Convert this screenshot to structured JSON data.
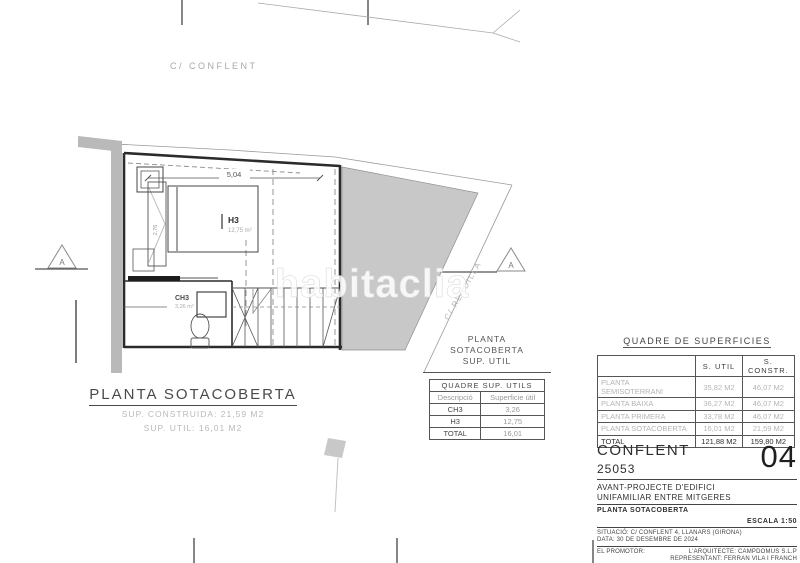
{
  "streets": {
    "conflent": "C/ CONFLENT",
    "rendilla": "C/ RENDILLA"
  },
  "watermark": "habitaclia",
  "plan": {
    "dim_width": "5,04",
    "dim_bed": "2,76",
    "room_h3": "H3",
    "room_h3_area": "12,75 m²",
    "room_ch3": "CH3",
    "room_ch3_area": "3,26 m²",
    "section_marker": "A",
    "title": "PLANTA SOTACOBERTA",
    "sup_construida": "SUP. CONSTRUIDA: 21,59 M2",
    "sup_util": "SUP. UTIL: 16,01 M2"
  },
  "util_table": {
    "heading_line1": "PLANTA",
    "heading_line2": "SOTACOBERTA",
    "heading_line3": "SUP. UTIL",
    "title": "QUADRE SUP. UTILS",
    "col_desc": "Descripció",
    "col_sup": "Superficie útil",
    "rows": [
      {
        "desc": "CH3",
        "value": "3,26"
      },
      {
        "desc": "H3",
        "value": "12,75"
      },
      {
        "desc": "TOTAL",
        "value": "16,01"
      }
    ]
  },
  "surfaces_table": {
    "title": "QUADRE DE SUPERFICIES",
    "col_util": "S. UTIL",
    "col_constr": "S. CONSTR.",
    "rows": [
      {
        "label": "PLANTA SEMISOTERRANI",
        "util": "35,82 M2",
        "constr": "46,07 M2"
      },
      {
        "label": "PLANTA BAIXA",
        "util": "36,27 M2",
        "constr": "46,07 M2"
      },
      {
        "label": "PLANTA PRIMERA",
        "util": "33,78 M2",
        "constr": "46,07 M2"
      },
      {
        "label": "PLANTA SOTACOBERTA",
        "util": "16,01 M2",
        "constr": "21,59 M2"
      },
      {
        "label": "TOTAL",
        "util": "121,88 M2",
        "constr": "159,80 M2"
      }
    ]
  },
  "title_block": {
    "project_name": "CONFLENT",
    "project_number": "25053",
    "sheet_number": "04",
    "description_line1": "AVANT-PROJECTE D'EDIFICI",
    "description_line2": "UNIFAMILIAR ENTRE MITGERES",
    "sheet_title": "PLANTA SOTACOBERTA",
    "scale": "ESCALA 1:50",
    "situacio": "SITUACIÓ: C/ CONFLENT 4, LLANARS (GIRONA)",
    "data": "DATA: 30 DE DESEMBRE DE 2024",
    "promotor": "EL PROMOTOR:",
    "arquitecte": "L'ARQUITECTE: CAMPDOMUS S.L.P",
    "representant": "REPRESENTANT: FERRAN VILA I FRANCH"
  },
  "colors": {
    "line": "#333333",
    "fill_gray": "#c8c8c8",
    "wall_gray": "#b9b9b9",
    "muted_text": "#b5b5b5"
  }
}
